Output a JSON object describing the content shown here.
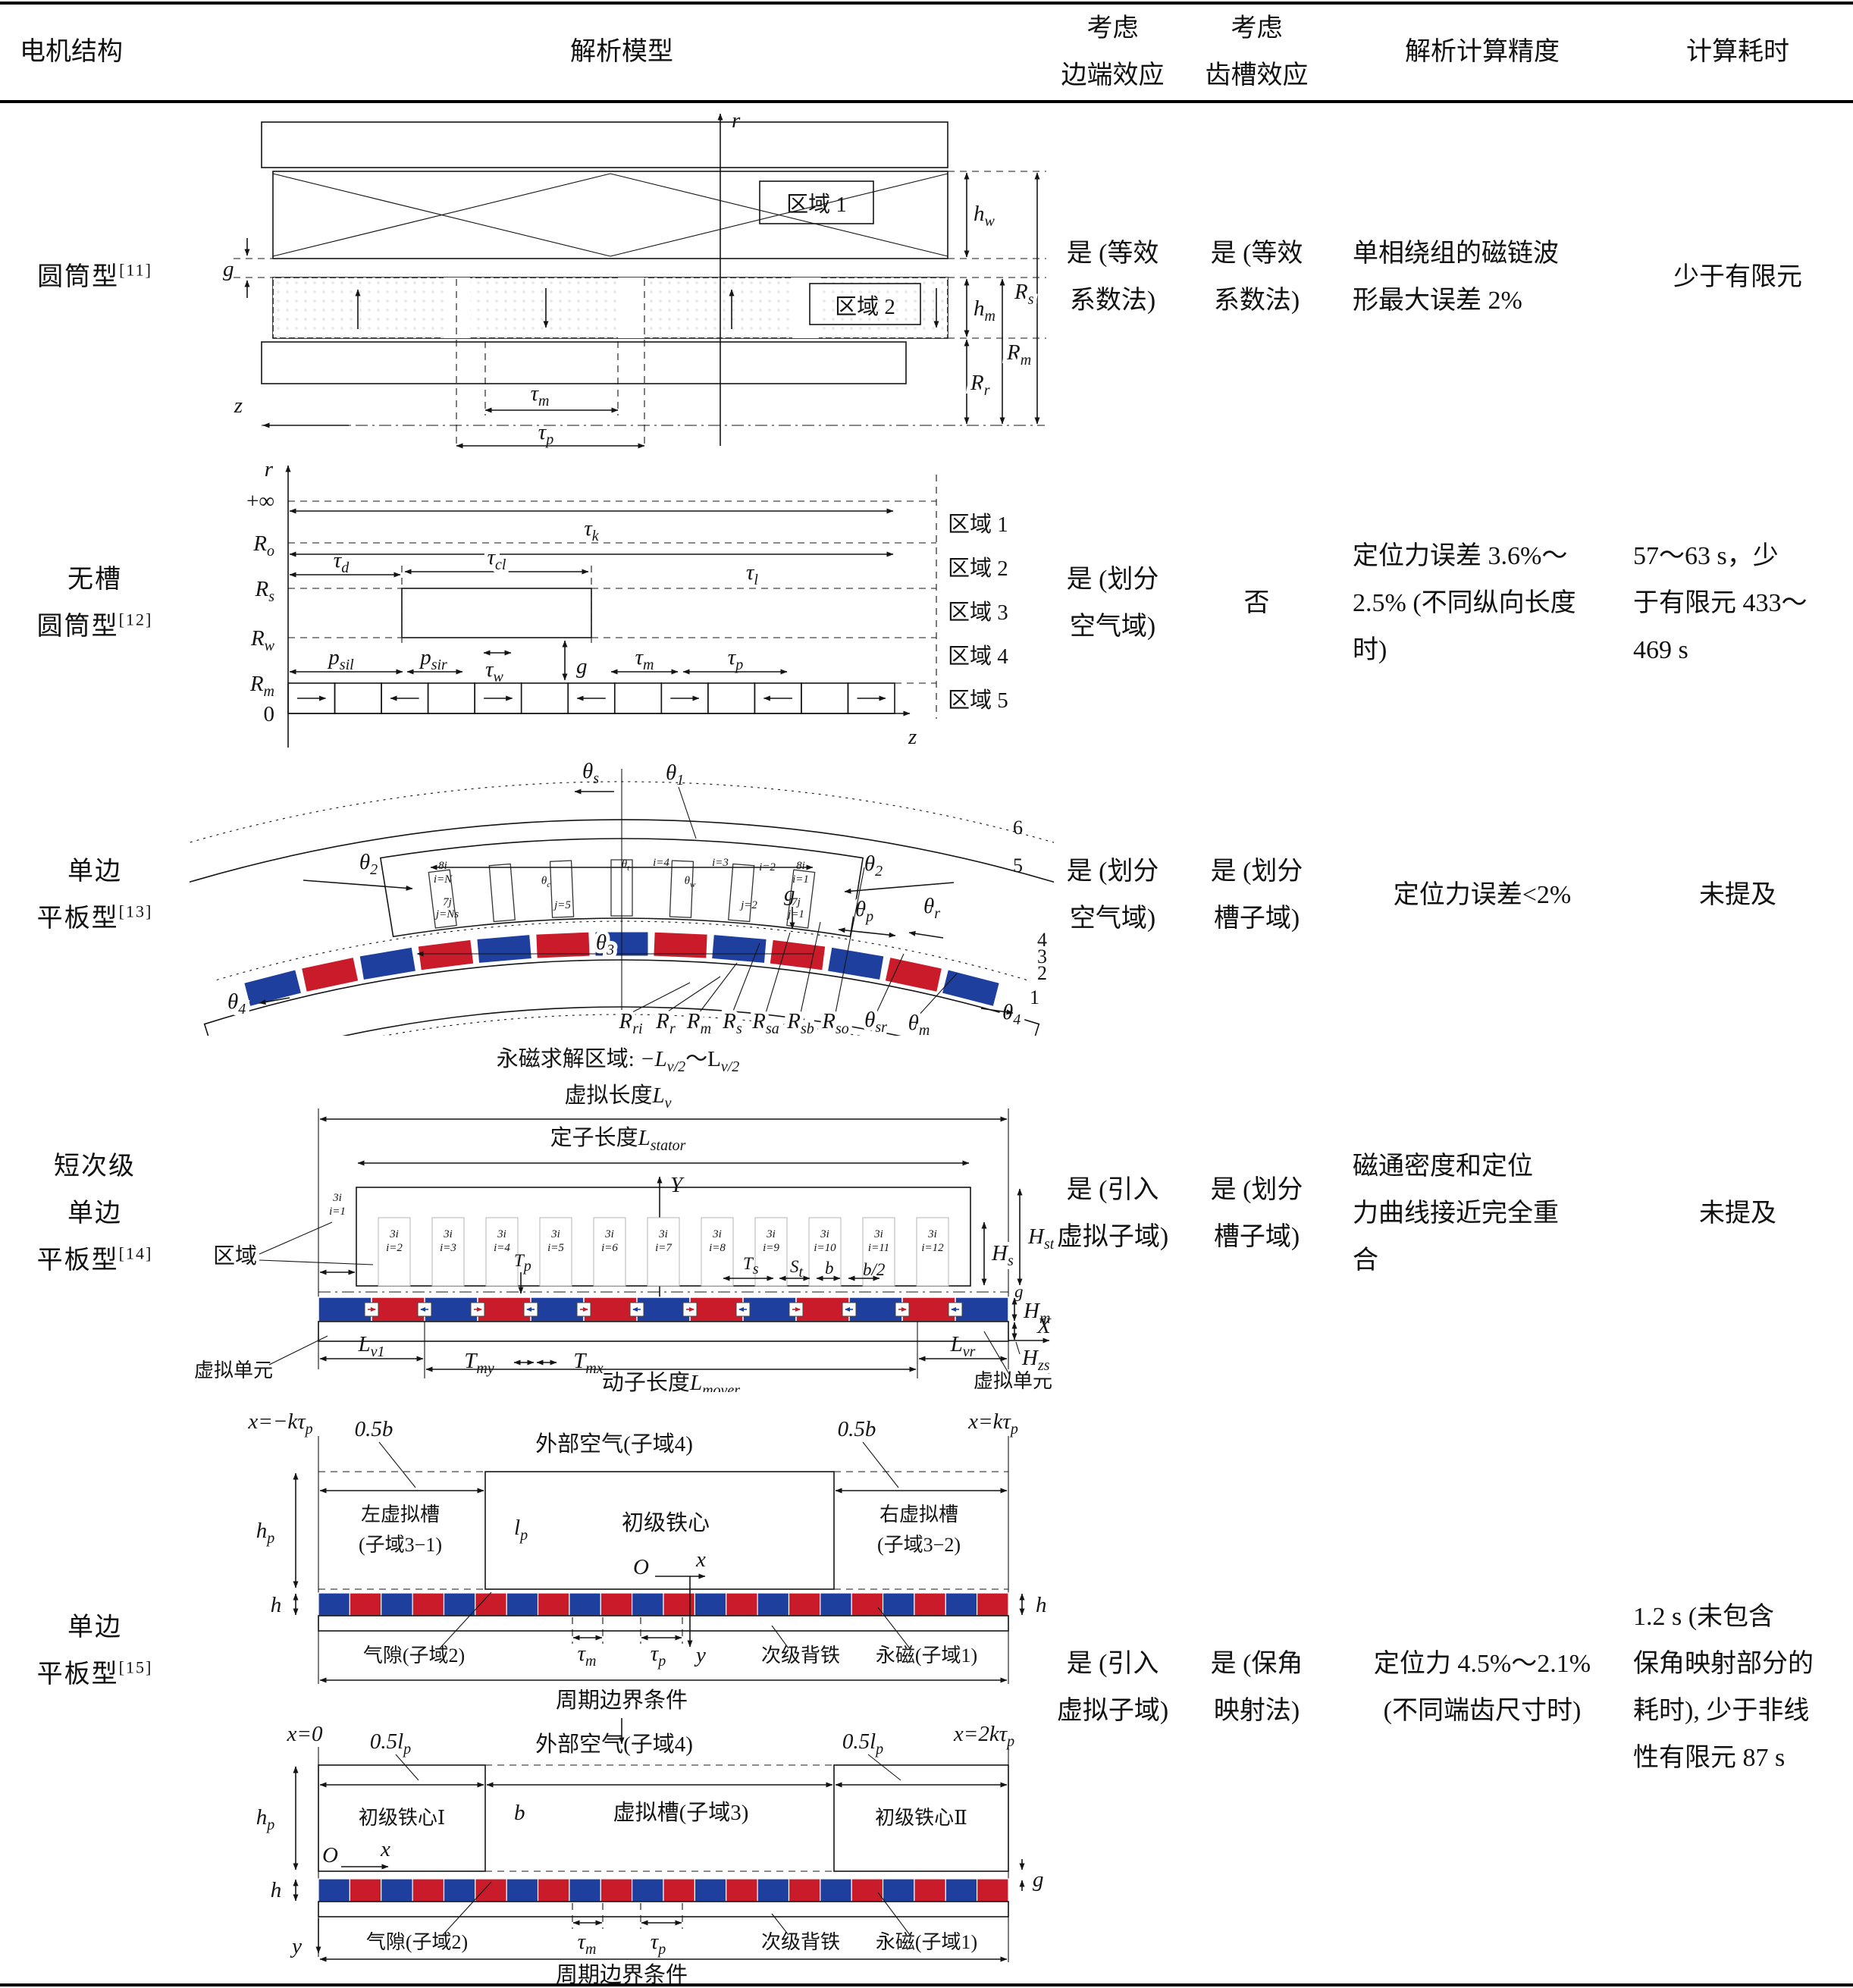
{
  "page": {
    "background": "#ffffff",
    "text_color": "#111111"
  },
  "colors": {
    "magnet_red": "#c91b2a",
    "magnet_blue": "#1e3f9e",
    "steel": "#c2c2c2",
    "steel_light": "#e6e6e6",
    "core_gray": "#d6d6d6",
    "backiron": "#cfcfcf",
    "magnet_gray": "#a9a9a9"
  },
  "header": {
    "col1": "电机结构",
    "col2": "解析模型",
    "col3_line1": "考虑",
    "col3_line2": "边端效应",
    "col4_line1": "考虑",
    "col4_line2": "齿槽效应",
    "col5": "解析计算精度",
    "col6": "计算耗时"
  },
  "rows": [
    {
      "structure": {
        "lines": [
          "圆筒型"
        ],
        "ref": "[11]"
      },
      "end_effect": [
        "是 (等效",
        "系数法)"
      ],
      "slot_effect": [
        "是 (等效",
        "系数法)"
      ],
      "accuracy": [
        "单相绕组的磁链波",
        "形最大误差 2%"
      ],
      "time": [
        "少于有限元"
      ],
      "diagram": {
        "axis_r": "r",
        "axis_z": "z",
        "g": "g",
        "region1": "区域 1",
        "region2": "区域 2",
        "hw": {
          "m": "h",
          "s": "w"
        },
        "hm": {
          "m": "h",
          "s": "m"
        },
        "Rs": {
          "m": "R",
          "s": "s"
        },
        "Rm": {
          "m": "R",
          "s": "m"
        },
        "Rr": {
          "m": "R",
          "s": "r"
        },
        "tau_m": {
          "m": "τ",
          "s": "m"
        },
        "tau_p": {
          "m": "τ",
          "s": "p"
        }
      }
    },
    {
      "structure": {
        "lines": [
          "无槽",
          "圆筒型"
        ],
        "ref": "[12]"
      },
      "end_effect": [
        "是 (划分",
        "空气域)"
      ],
      "slot_effect": [
        "否"
      ],
      "accuracy": [
        "定位力误差 3.6%～",
        "2.5% (不同纵向长度",
        "时)"
      ],
      "time": [
        "57～63 s，少",
        "于有限元 433～",
        "469 s"
      ],
      "diagram": {
        "axis_r": "r",
        "axis_z": "z",
        "inf": "+∞",
        "zero": "0",
        "Ro": {
          "m": "R",
          "s": "o"
        },
        "Rs": {
          "m": "R",
          "s": "s"
        },
        "Rw": {
          "m": "R",
          "s": "w"
        },
        "Rm": {
          "m": "R",
          "s": "m"
        },
        "tau_k": {
          "m": "τ",
          "s": "k"
        },
        "tau_l": {
          "m": "τ",
          "s": "l"
        },
        "tau_d": {
          "m": "τ",
          "s": "d"
        },
        "tau_cl": {
          "m": "τ",
          "s": "cl"
        },
        "p_sil": {
          "m": "p",
          "s": "sil"
        },
        "p_sir": {
          "m": "p",
          "s": "sir"
        },
        "tau_w": {
          "m": "τ",
          "s": "w"
        },
        "g": "g",
        "tau_m": {
          "m": "τ",
          "s": "m"
        },
        "tau_p": {
          "m": "τ",
          "s": "p"
        },
        "regions": [
          "区域 1",
          "区域 2",
          "区域 3",
          "区域 4",
          "区域 5"
        ],
        "magnet_cells": 13
      }
    },
    {
      "structure": {
        "lines": [
          "单边",
          "平板型"
        ],
        "ref": "[13]"
      },
      "end_effect": [
        "是 (划分",
        "空气域)"
      ],
      "slot_effect": [
        "是 (划分",
        "槽子域)"
      ],
      "accuracy": [
        "定位力误差<2%"
      ],
      "time": [
        "未提及"
      ],
      "diagram": {
        "theta_s": {
          "m": "θ",
          "s": "s"
        },
        "theta_1": {
          "m": "θ",
          "s": "1"
        },
        "theta_2": {
          "m": "θ",
          "s": "2"
        },
        "theta_3": {
          "m": "θ",
          "s": "3"
        },
        "theta_4": {
          "m": "θ",
          "s": "4"
        },
        "g": "g",
        "theta_p": {
          "m": "θ",
          "s": "p"
        },
        "theta_r": {
          "m": "θ",
          "s": "r"
        },
        "R_ri": {
          "m": "R",
          "s": "ri"
        },
        "R_r": {
          "m": "R",
          "s": "r"
        },
        "R_m": {
          "m": "R",
          "s": "m"
        },
        "R_s": {
          "m": "R",
          "s": "s"
        },
        "R_sa": {
          "m": "R",
          "s": "sa"
        },
        "R_sb": {
          "m": "R",
          "s": "sb"
        },
        "R_so": {
          "m": "R",
          "s": "so"
        },
        "theta_sr": {
          "m": "θ",
          "s": "sr"
        },
        "theta_m": {
          "m": "θ",
          "s": "m"
        },
        "nums": [
          "6",
          "5",
          "4",
          "3",
          "2",
          "1"
        ],
        "tiny": {
          "lt": "8i",
          "li": "i=N",
          "l7": "7j",
          "lj": "j=Ns",
          "rt": "8i",
          "ri": "i=1",
          "r7": "7j",
          "rj": "j=1",
          "i4": "i=4",
          "i3": "i=3",
          "i2": "i=2",
          "j5": "j=5",
          "j2": "j=2",
          "theta_c": {
            "m": "θ",
            "s": "c"
          },
          "theta_t": {
            "m": "θ",
            "s": "t"
          },
          "theta_w": {
            "m": "θ",
            "s": "w"
          }
        },
        "magnet_count": 13,
        "slot_count": 7
      }
    },
    {
      "structure": {
        "lines": [
          "短次级",
          "单边",
          "平板型"
        ],
        "ref": "[14]"
      },
      "end_effect": [
        "是 (引入",
        "虚拟子域)"
      ],
      "slot_effect": [
        "是 (划分",
        "槽子域)"
      ],
      "accuracy": [
        "磁通密度和定位",
        "力曲线接近完全重",
        "合"
      ],
      "time": [
        "未提及"
      ],
      "diagram": {
        "title_cn": "永磁求解区域: ",
        "title_m1": "−L",
        "title_s1": "v/2",
        "title_m2": "～L",
        "title_s2": "v/2",
        "virt_cn": "虚拟长度",
        "virt_m": "L",
        "virt_s": "v",
        "stator_cn": "定子长度",
        "stator_m": "L",
        "stator_s": "stator",
        "axis_Y": "Y",
        "axis_X": "X",
        "region": "区域",
        "virtual_unit": "虚拟单元",
        "slot1_top": "3i",
        "slot1_i": "i=1",
        "slot_top": "3i",
        "slots": [
          "i=2",
          "i=3",
          "i=4",
          "i=5",
          "i=6",
          "i=7",
          "i=8",
          "i=9",
          "i=10",
          "i=11",
          "i=12"
        ],
        "T_p": {
          "m": "T",
          "s": "p"
        },
        "T_s": {
          "m": "T",
          "s": "s"
        },
        "S_t": {
          "m": "S",
          "s": "t"
        },
        "b": "b",
        "b2": "b/2",
        "H_s": {
          "m": "H",
          "s": "s"
        },
        "H_st": {
          "m": "H",
          "s": "st"
        },
        "g": "g",
        "H_m": {
          "m": "H",
          "s": "m"
        },
        "H_zs": {
          "m": "H",
          "s": "zs"
        },
        "L_v1": {
          "m": "L",
          "s": "v1"
        },
        "T_my": {
          "m": "T",
          "s": "my"
        },
        "T_mx": {
          "m": "T",
          "s": "mx"
        },
        "L_vr": {
          "m": "L",
          "s": "vr"
        },
        "mover_cn": "动子长度",
        "mover_m": "L",
        "mover_s": "mover"
      }
    },
    {
      "structure": {
        "lines": [
          "单边",
          "平板型"
        ],
        "ref": "[15]"
      },
      "end_effect": [
        "是 (引入",
        "虚拟子域)"
      ],
      "slot_effect": [
        "是 (保角",
        "映射法)"
      ],
      "accuracy": [
        "定位力 4.5%～2.1%",
        "(不同端齿尺寸时)"
      ],
      "time": [
        "1.2 s (未包含",
        "保角映射部分的",
        "耗时), 少于非线",
        "性有限元 87 s"
      ],
      "diagram": {
        "up": {
          "x_left": {
            "m": "x=−kτ",
            "s": "p"
          },
          "half_b": "0.5b",
          "outer_air": "外部空气(子域4)",
          "x_right": {
            "m": "x=kτ",
            "s": "p"
          },
          "h_p": {
            "m": "h",
            "s": "p"
          },
          "left_slot1": "左虚拟槽",
          "left_slot2": "(子域3−1)",
          "l_p": {
            "m": "l",
            "s": "p"
          },
          "core": "初级铁心",
          "O": "O",
          "x": "x",
          "right_slot1": "右虚拟槽",
          "right_slot2": "(子域3−2)",
          "h": "h",
          "airgap": "气隙(子域2)",
          "tau_m": {
            "m": "τ",
            "s": "m"
          },
          "tau_p": {
            "m": "τ",
            "s": "p"
          },
          "y": "y",
          "backiron": "次级背铁",
          "pm": "永磁(子域1)",
          "periodic": "周期边界条件"
        },
        "low": {
          "x_zero": "x=0",
          "half_lp": {
            "m": "0.5l",
            "s": "p"
          },
          "outer_air": "外部空气(子域4)",
          "x_right": {
            "m": "x=2kτ",
            "s": "p"
          },
          "h_p": {
            "m": "h",
            "s": "p"
          },
          "core1": "初级铁心Ⅰ",
          "b": "b",
          "virtual_slot": "虚拟槽(子域3)",
          "core2": "初级铁心Ⅱ",
          "O": "O",
          "x": "x",
          "g": "g",
          "h": "h",
          "airgap": "气隙(子域2)",
          "tau_m": {
            "m": "τ",
            "s": "m"
          },
          "tau_p": {
            "m": "τ",
            "s": "p"
          },
          "y": "y",
          "backiron": "次级背铁",
          "pm": "永磁(子域1)",
          "periodic": "周期边界条件"
        }
      }
    }
  ]
}
